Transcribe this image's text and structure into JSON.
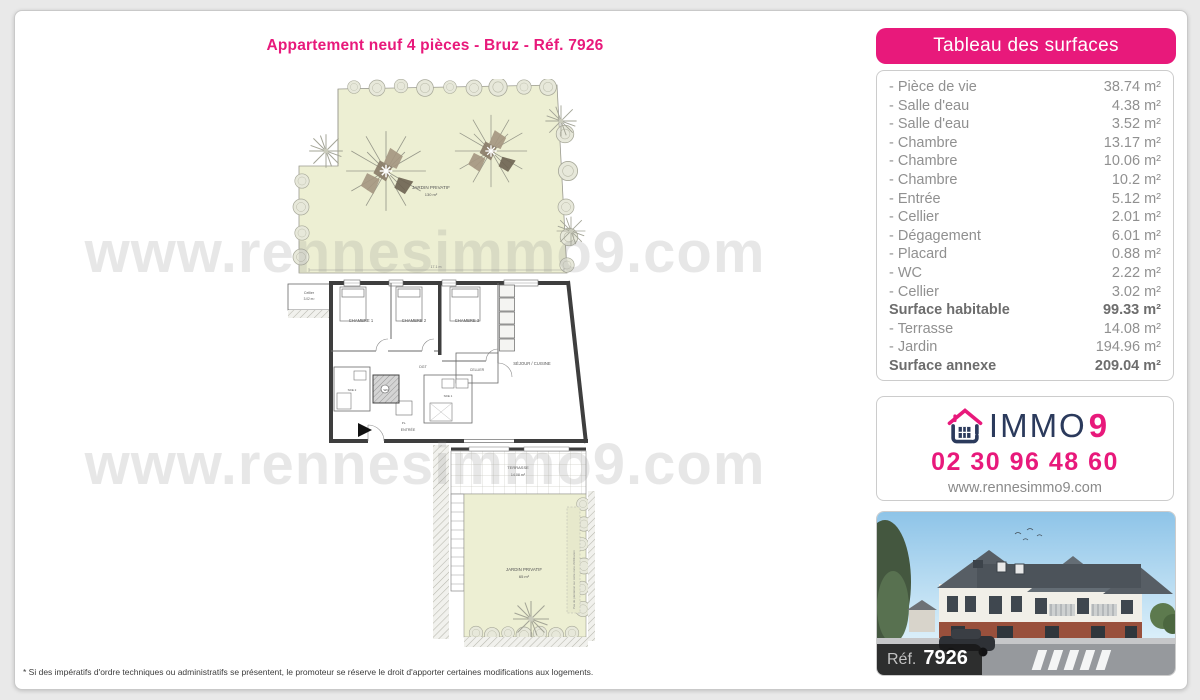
{
  "page": {
    "title": "Appartement neuf 4 pièces - Bruz - Réf. 7926",
    "watermark": "www.rennesimmo9.com",
    "footnote": "* Si des impératifs d'ordre techniques ou administratifs se présentent, le promoteur se réserve le droit d'apporter certaines modifications aux logements."
  },
  "colors": {
    "accent_pink": "#e8197b",
    "brand_navy": "#2b3a5c",
    "garden_green": "#edefd3"
  },
  "surfaces": {
    "header": "Tableau des surfaces",
    "rows": [
      {
        "label": "- Pièce de vie",
        "value": "38.74 m²",
        "bold": false
      },
      {
        "label": "- Salle d'eau",
        "value": "4.38 m²",
        "bold": false
      },
      {
        "label": "- Salle d'eau",
        "value": "3.52 m²",
        "bold": false
      },
      {
        "label": "- Chambre",
        "value": "13.17 m²",
        "bold": false
      },
      {
        "label": "- Chambre",
        "value": "10.06 m²",
        "bold": false
      },
      {
        "label": "- Chambre",
        "value": "10.2 m²",
        "bold": false
      },
      {
        "label": "- Entrée",
        "value": "5.12 m²",
        "bold": false
      },
      {
        "label": "- Cellier",
        "value": "2.01 m²",
        "bold": false
      },
      {
        "label": "- Dégagement",
        "value": "6.01 m²",
        "bold": false
      },
      {
        "label": "- Placard",
        "value": "0.88 m²",
        "bold": false
      },
      {
        "label": "- WC",
        "value": "2.22 m²",
        "bold": false
      },
      {
        "label": "- Cellier",
        "value": "3.02 m²",
        "bold": false
      },
      {
        "label": "Surface habitable",
        "value": "99.33 m²",
        "bold": true
      },
      {
        "label": "- Terrasse",
        "value": "14.08 m²",
        "bold": false
      },
      {
        "label": "- Jardin",
        "value": "194.96 m²",
        "bold": false
      },
      {
        "label": "Surface annexe",
        "value": "209.04 m²",
        "bold": true
      }
    ]
  },
  "contact": {
    "brand": "IMMO",
    "brand_digit": "9",
    "phone": "02 30 96 48 60",
    "website": "www.rennesimmo9.com"
  },
  "photo": {
    "ref_label": "Réf.",
    "ref_number": "7926"
  },
  "plan": {
    "garden_top": {
      "label": "JARDIN PRIVATIF",
      "area": "130 m²"
    },
    "garden_dim": "17.1 m",
    "cellier_ext": {
      "label": "Cellier",
      "area": "3.02 m²"
    },
    "rooms": {
      "chambre1": "CHAMBRE 1",
      "chambre2": "CHAMBRE 2",
      "chambre3": "CHAMBRE 3",
      "sejour": "SÉJOUR / CUISINE",
      "cellier": "CELLIER",
      "dgt": "DGT",
      "sde1": "SDE 1",
      "sde2": "SDE 2",
      "wc": "WC",
      "placard": "PL.",
      "entree": "ENTRÉE"
    },
    "terrace": {
      "label": "TERRASSE",
      "area": "14.08 m²"
    },
    "garden_bottom": {
      "label": "JARDIN PRIVATIF",
      "area": "65 m²"
    },
    "note_vertical": "Pas de plantation sur cette zone d'infiltration"
  }
}
